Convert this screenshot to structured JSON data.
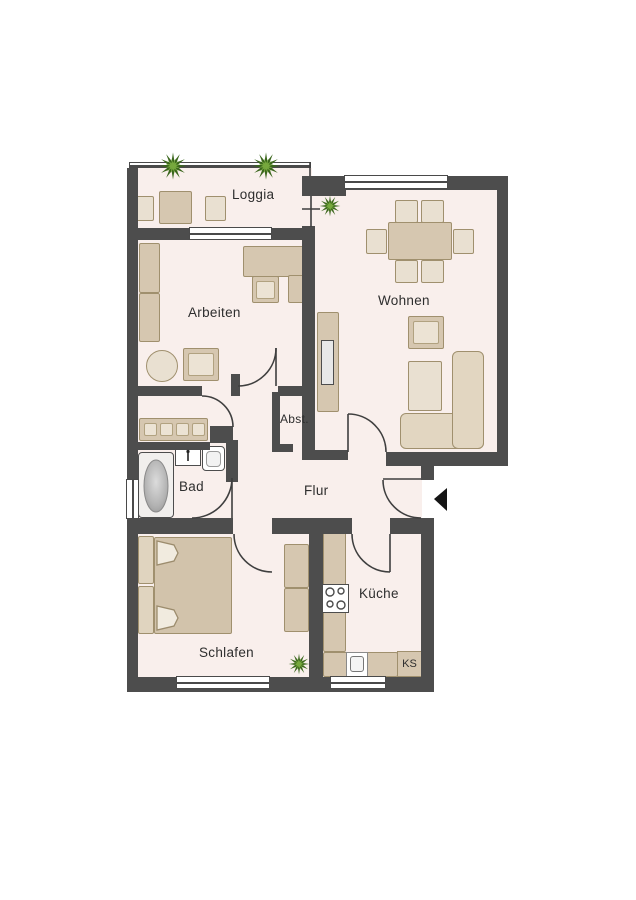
{
  "floor_plan": {
    "rooms": {
      "loggia": {
        "label": "Loggia"
      },
      "arbeiten": {
        "label": "Arbeiten"
      },
      "wohnen": {
        "label": "Wohnen"
      },
      "abstellraum": {
        "label": "Abst."
      },
      "bad": {
        "label": "Bad"
      },
      "flur": {
        "label": "Flur"
      },
      "schlafen": {
        "label": "Schlafen"
      },
      "kueche": {
        "label": "Küche"
      }
    },
    "appliances": {
      "fridge": {
        "label": "KS"
      }
    },
    "icons": {
      "entrance": "entrance-arrow-icon",
      "plants": "plant-icon"
    },
    "colors": {
      "wall": "#4d4d4d",
      "floor": "#f9efec",
      "furniture": "#d6c7b0",
      "furniture_light": "#e9e0d1",
      "plant_dark": "#3a661c",
      "plant_light": "#76a83d",
      "background": "#ffffff"
    }
  }
}
